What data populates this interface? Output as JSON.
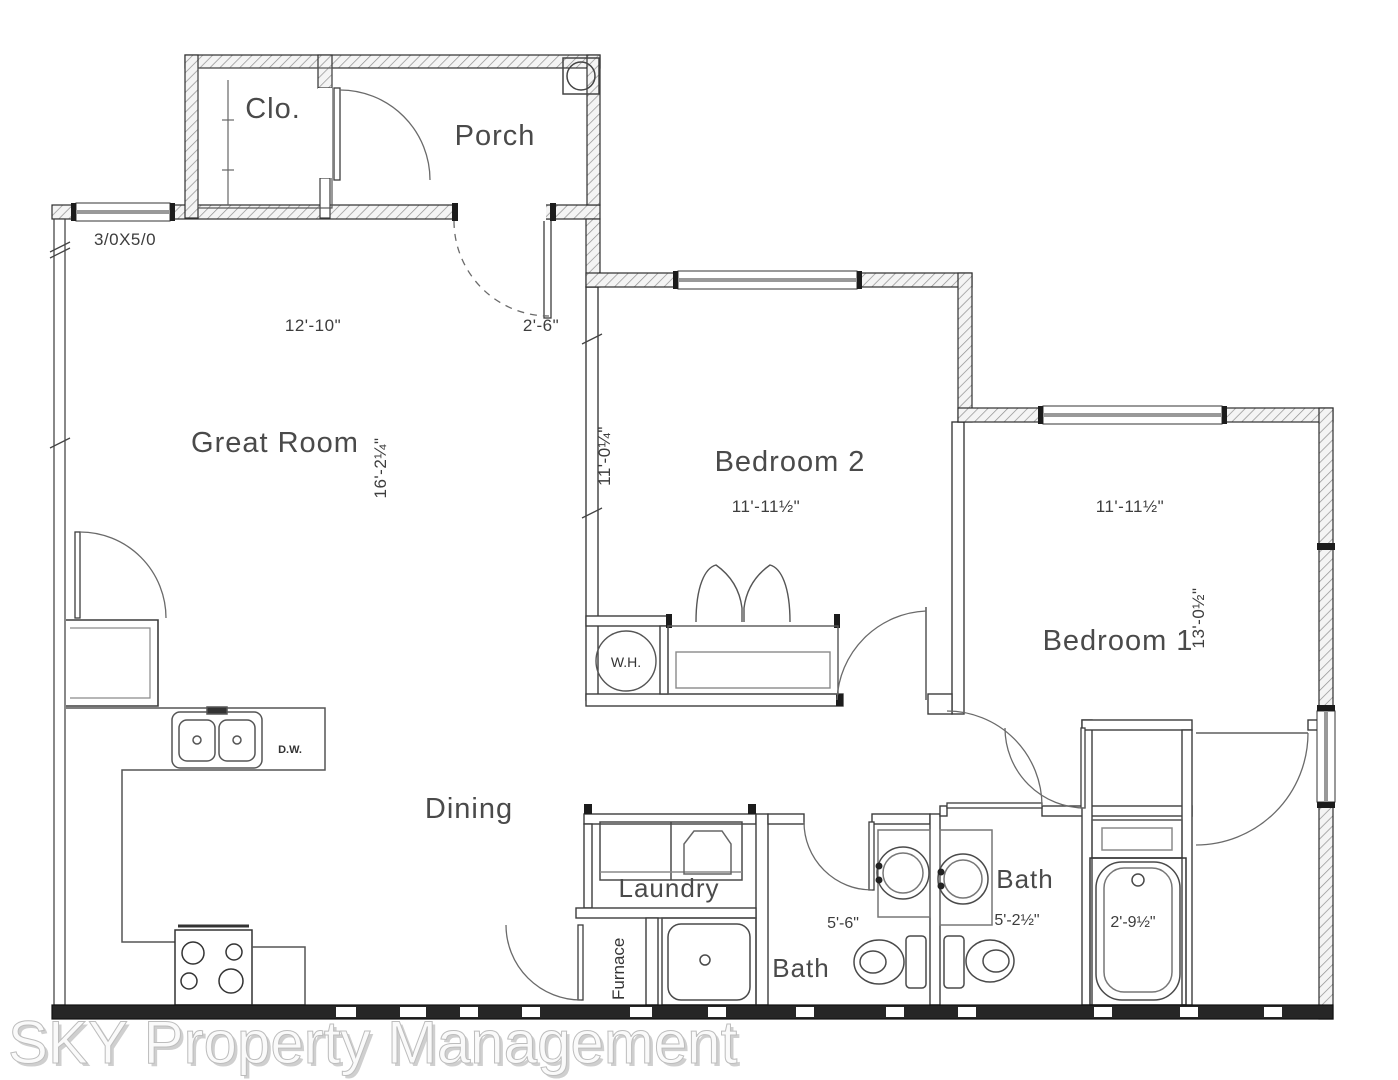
{
  "document": {
    "type": "residential floor plan",
    "watermark": "SKY Property Management"
  },
  "rooms": {
    "porch": {
      "label": "Porch"
    },
    "closet": {
      "label": "Clo."
    },
    "great_room": {
      "label": "Great Room",
      "width": "12'-10\"",
      "depth": "16'-2¼\""
    },
    "bedroom2": {
      "label": "Bedroom 2",
      "width": "11'-11½\"",
      "depth": "11'-0¼\""
    },
    "bedroom1": {
      "label": "Bedroom 1",
      "width": "11'-11½\"",
      "depth": "13'-0½\""
    },
    "dining": {
      "label": "Dining"
    },
    "laundry": {
      "label": "Laundry"
    },
    "bath1": {
      "label": "Bath",
      "width": "5'-6\""
    },
    "bath2": {
      "label": "Bath",
      "width": "5'-2½\""
    },
    "furnace": {
      "label": "Furnace"
    }
  },
  "fixtures": {
    "water_heater": {
      "label": "W.H."
    },
    "dishwasher": {
      "label": "D.W."
    },
    "tub": {
      "width": "2'-9½\""
    }
  },
  "annotations": {
    "window_size": "3/0X5/0",
    "front_door_width": "2'-6\""
  },
  "colors": {
    "wall_outline": "#2e2e2e",
    "thin_wall": "#3d3d3d",
    "hatch": "#8f8f8f",
    "fixture_line": "#555555",
    "label_text": "#4a4a4a",
    "watermark_fill": "#fafafa"
  }
}
